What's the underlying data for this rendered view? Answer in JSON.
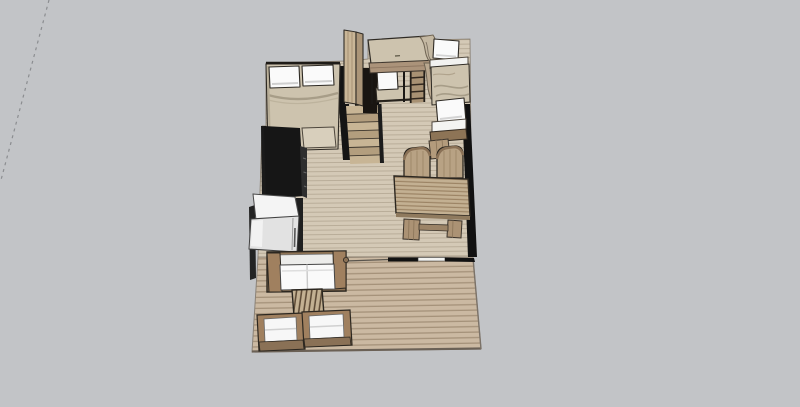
{
  "app": {
    "view": "3d-model-viewport",
    "description": "SketchUp-style 3D overhead view of a small studio house floor plan with deck"
  },
  "colors": {
    "background": "#c2c4c7",
    "axis_dash": "#8b8d90",
    "floor_interior": "#d4c9b6",
    "floor_interior_line": "#b9ad99",
    "floor_deck": "#cbb9a2",
    "floor_deck_line": "#a5927a",
    "wall": "#111111",
    "window_sill": "#f2f2f0",
    "wood": "#b7a184",
    "wood_dark": "#8d7557",
    "wood_light": "#d2c2a7",
    "outline": "#2e2a24",
    "bedding": "#cdc3ae",
    "bedding_shadow": "#a79d88",
    "white": "#fafafa",
    "counter_top": "#161616",
    "counter_face": "#2e2e2e",
    "fridge_top": "#f4f4f4",
    "fridge_front": "#e2e2e2",
    "table_stripe_a": "#c3b092",
    "table_stripe_b": "#9c8465",
    "stair_tread_a": "#c8b595",
    "stair_tread_b": "#b39e7e",
    "deck_edge": "#6b6156"
  },
  "scene": {
    "objects": [
      {
        "name": "axis-guide-line"
      },
      {
        "name": "interior-floor"
      },
      {
        "name": "deck-floor"
      },
      {
        "name": "master-bed"
      },
      {
        "name": "wardrobe-column"
      },
      {
        "name": "staircase"
      },
      {
        "name": "loft-bunk-bed"
      },
      {
        "name": "lower-bunk-bed"
      },
      {
        "name": "side-bed"
      },
      {
        "name": "kitchen-counter"
      },
      {
        "name": "refrigerator"
      },
      {
        "name": "dining-table"
      },
      {
        "name": "dining-chair"
      },
      {
        "name": "indoor-sofa"
      },
      {
        "name": "coffee-table"
      },
      {
        "name": "outdoor-armchair"
      },
      {
        "name": "window-sill"
      },
      {
        "name": "walls"
      }
    ]
  }
}
